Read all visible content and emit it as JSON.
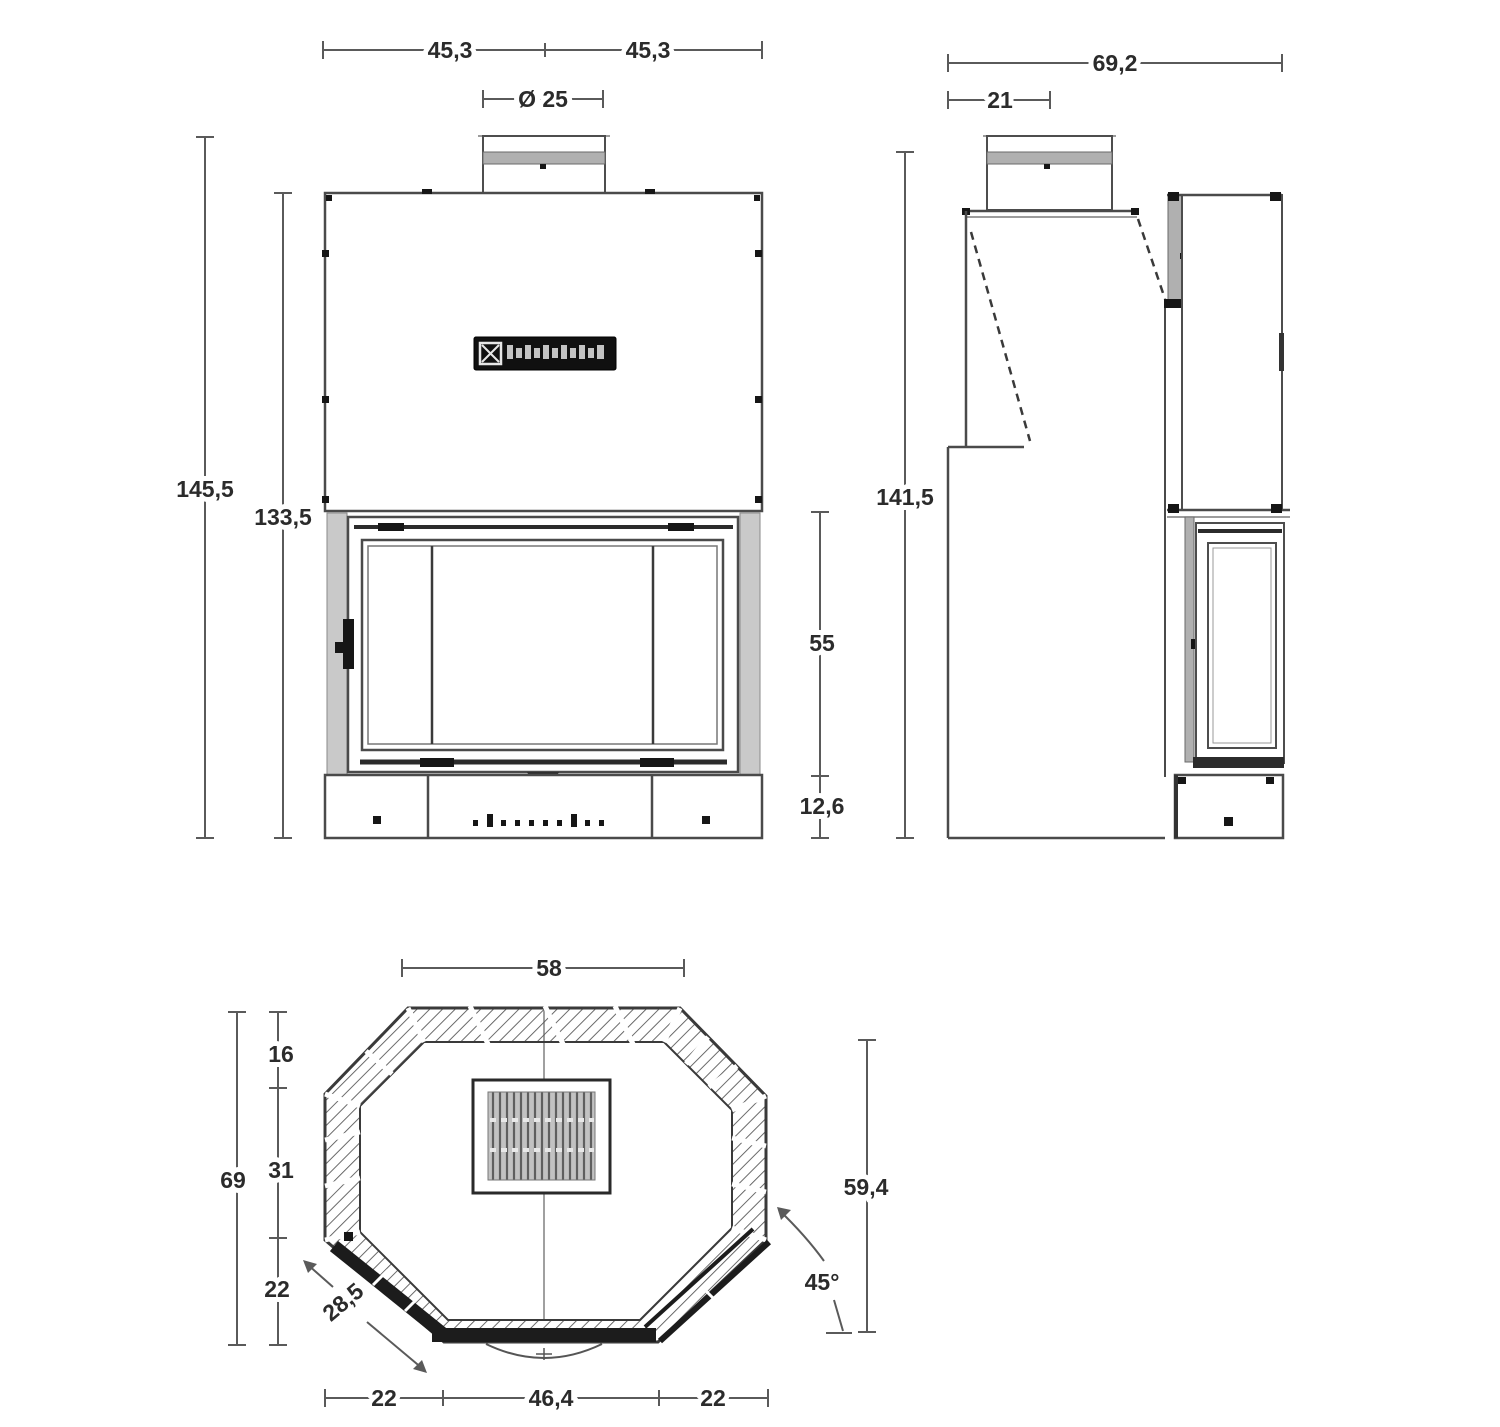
{
  "palette": {
    "background": "#ffffff",
    "line": "#4d4d4d",
    "dim_line": "#5a5a5a",
    "text": "#2b2b2b",
    "dark": "#161616",
    "gray_fill": "#b0b0b0",
    "light_fill": "#c9c9c9"
  },
  "views": {
    "front": {
      "dims": {
        "width_left": "45,3",
        "width_right": "45,3",
        "flue_diameter": "Ø 25",
        "total_height": "145,5",
        "body_height": "133,5",
        "door_height": "55",
        "base_height": "12,6"
      }
    },
    "side": {
      "dims": {
        "total_depth": "69,2",
        "flue_depth": "21",
        "total_height": "141,5"
      }
    },
    "plan": {
      "dims": {
        "top_width": "58",
        "overall_depth": "69",
        "rear_depth": "16",
        "side_depth": "31",
        "corner_depth": "22",
        "corner_width": "28,5",
        "bottom_left_width": "22",
        "front_width": "46,4",
        "bottom_right_width": "22",
        "front_depth": "59,4",
        "corner_angle": "45°"
      }
    }
  }
}
